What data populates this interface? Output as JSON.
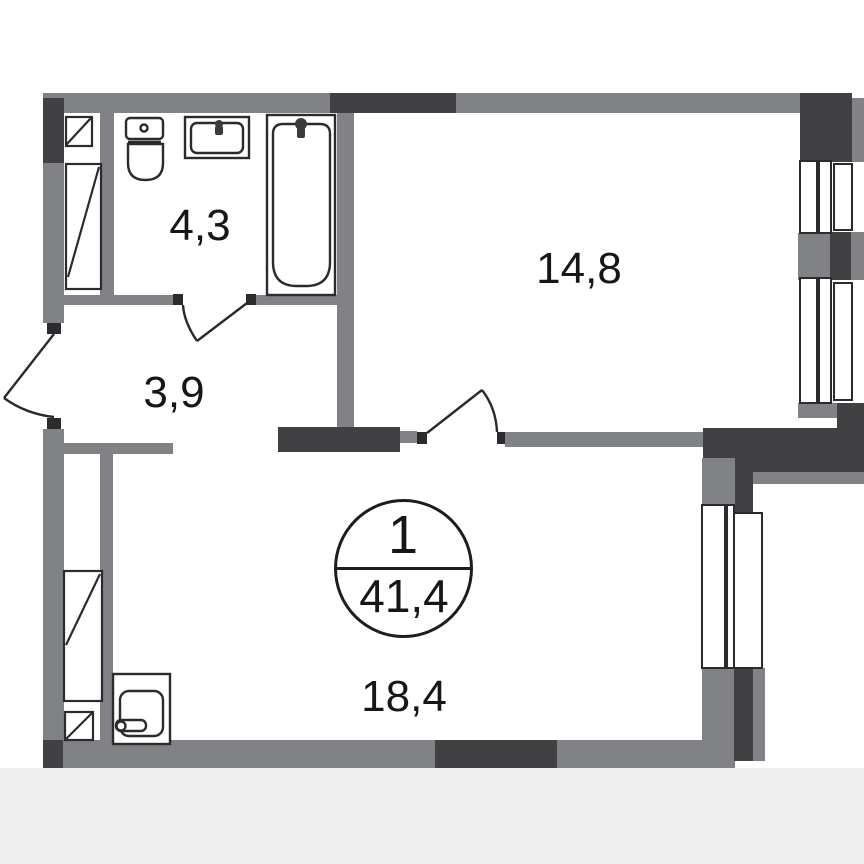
{
  "plan": {
    "title": "1-room apartment floor plan",
    "badge": {
      "rooms_count": "1",
      "total_area": "41,4"
    },
    "rooms": [
      {
        "id": "bathroom",
        "area": "4,3"
      },
      {
        "id": "hallway",
        "area": "3,9"
      },
      {
        "id": "living-room",
        "area": "14,8"
      },
      {
        "id": "kitchen-living",
        "area": "18,4"
      }
    ],
    "fixtures": [
      "toilet",
      "washbasin",
      "bathtub",
      "kitchen-sink"
    ],
    "colors": {
      "wall": "#808285",
      "wall_dark": "#414144",
      "outline": "#2b2b2d",
      "text": "#161616",
      "footer_bg": "#efeff0",
      "background": "#ffffff"
    }
  }
}
